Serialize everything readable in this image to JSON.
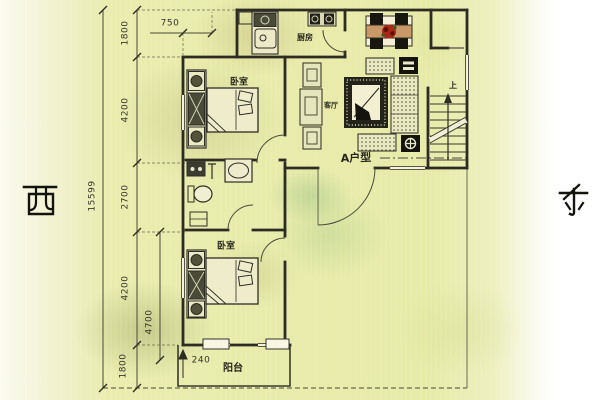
{
  "compass": {
    "west": "西",
    "east": "东"
  },
  "unit_type_label": "A户型",
  "rooms": {
    "bedroom_upper": "卧室",
    "bedroom_lower": "卧室",
    "kitchen": "厨房",
    "living_room": "客厅",
    "balcony": "阳台"
  },
  "stairs": {
    "up_label": "上"
  },
  "dimensions": {
    "left_total": "15599",
    "left_chain": [
      "1800",
      "4200",
      "2700",
      "4200",
      "1800"
    ],
    "inner_depth": "4700",
    "top_offset": "750",
    "balcony_wall": "240"
  },
  "colors": {
    "paper_tint": "#e8ecad",
    "line": "#32322a",
    "furniture_dark": "#17170f",
    "table_wood": "#c89868",
    "flower_red": "#a82818"
  }
}
